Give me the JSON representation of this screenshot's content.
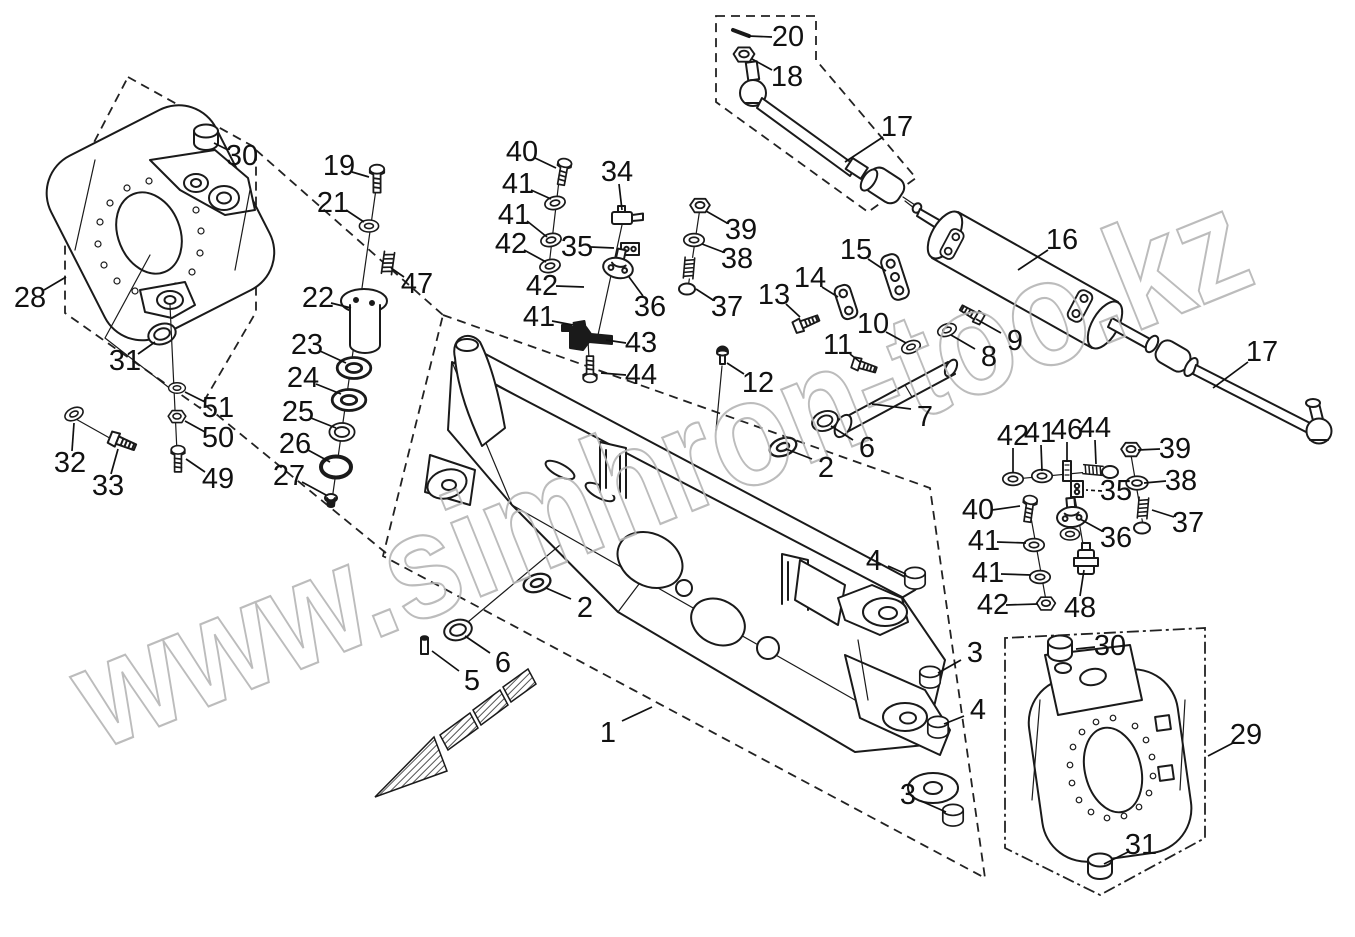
{
  "watermark": {
    "text": "www.simhron-too.kz",
    "color": "#b5b5b5"
  },
  "diagram": {
    "type": "exploded-parts-diagram",
    "subject": "front-axle-assembly",
    "line_color": "#1a1a1a",
    "background": "#ffffff",
    "callouts": [
      {
        "n": "1",
        "x": 608,
        "y": 733,
        "lead": [
          622,
          721,
          652,
          707
        ]
      },
      {
        "n": "2",
        "x": 585,
        "y": 608,
        "lead": [
          571,
          599,
          546,
          588
        ]
      },
      {
        "n": "2",
        "x": 826,
        "y": 468,
        "lead": [
          812,
          459,
          786,
          449
        ]
      },
      {
        "n": "3",
        "x": 975,
        "y": 653,
        "lead": [
          961,
          660,
          938,
          673
        ]
      },
      {
        "n": "3",
        "x": 908,
        "y": 795,
        "lead": [
          921,
          801,
          946,
          812
        ]
      },
      {
        "n": "4",
        "x": 874,
        "y": 561,
        "lead": [
          888,
          566,
          906,
          574
        ]
      },
      {
        "n": "4",
        "x": 978,
        "y": 710,
        "lead": [
          964,
          716,
          944,
          724
        ]
      },
      {
        "n": "5",
        "x": 472,
        "y": 681,
        "lead": [
          459,
          671,
          432,
          651
        ]
      },
      {
        "n": "6",
        "x": 503,
        "y": 663,
        "lead": [
          490,
          653,
          465,
          636
        ]
      },
      {
        "n": "6",
        "x": 867,
        "y": 448,
        "lead": [
          853,
          440,
          831,
          426
        ]
      },
      {
        "n": "7",
        "x": 925,
        "y": 417,
        "lead": [
          911,
          409,
          872,
          404
        ]
      },
      {
        "n": "8",
        "x": 989,
        "y": 357,
        "lead": [
          975,
          349,
          951,
          335
        ]
      },
      {
        "n": "9",
        "x": 1015,
        "y": 341,
        "lead": [
          1001,
          333,
          976,
          319
        ]
      },
      {
        "n": "10",
        "x": 873,
        "y": 324,
        "lead": [
          886,
          332,
          906,
          343
        ]
      },
      {
        "n": "11",
        "x": 838,
        "y": 345,
        "lead": [
          850,
          354,
          860,
          362
        ]
      },
      {
        "n": "12",
        "x": 758,
        "y": 383,
        "lead": [
          744,
          374,
          727,
          363
        ]
      },
      {
        "n": "13",
        "x": 774,
        "y": 295,
        "lead": [
          786,
          304,
          800,
          317
        ]
      },
      {
        "n": "14",
        "x": 810,
        "y": 278,
        "lead": [
          822,
          287,
          838,
          297
        ]
      },
      {
        "n": "15",
        "x": 856,
        "y": 250,
        "lead": [
          868,
          259,
          886,
          271
        ]
      },
      {
        "n": "16",
        "x": 1062,
        "y": 240,
        "lead": [
          1048,
          250,
          1018,
          270
        ]
      },
      {
        "n": "17",
        "x": 897,
        "y": 127,
        "lead": [
          883,
          137,
          845,
          162
        ]
      },
      {
        "n": "17",
        "x": 1262,
        "y": 352,
        "lead": [
          1248,
          362,
          1213,
          388
        ]
      },
      {
        "n": "18",
        "x": 787,
        "y": 77,
        "lead": [
          772,
          70,
          752,
          59
        ]
      },
      {
        "n": "19",
        "x": 339,
        "y": 166,
        "lead": [
          352,
          172,
          369,
          177
        ]
      },
      {
        "n": "20",
        "x": 788,
        "y": 37,
        "lead": [
          772,
          37,
          748,
          36
        ]
      },
      {
        "n": "21",
        "x": 333,
        "y": 203,
        "lead": [
          346,
          210,
          364,
          222
        ]
      },
      {
        "n": "22",
        "x": 318,
        "y": 298,
        "lead": [
          331,
          303,
          351,
          308
        ]
      },
      {
        "n": "23",
        "x": 307,
        "y": 345,
        "lead": [
          320,
          351,
          346,
          363
        ]
      },
      {
        "n": "24",
        "x": 303,
        "y": 378,
        "lead": [
          316,
          384,
          341,
          394
        ]
      },
      {
        "n": "25",
        "x": 298,
        "y": 412,
        "lead": [
          311,
          418,
          336,
          428
        ]
      },
      {
        "n": "26",
        "x": 295,
        "y": 444,
        "lead": [
          308,
          450,
          330,
          462
        ]
      },
      {
        "n": "27",
        "x": 289,
        "y": 476,
        "lead": [
          302,
          482,
          326,
          495
        ]
      },
      {
        "n": "28",
        "x": 30,
        "y": 298,
        "lead": [
          44,
          290,
          66,
          277
        ]
      },
      {
        "n": "29",
        "x": 1246,
        "y": 735,
        "lead": [
          1233,
          743,
          1208,
          756
        ]
      },
      {
        "n": "30",
        "x": 242,
        "y": 156,
        "lead": [
          228,
          150,
          214,
          143
        ]
      },
      {
        "n": "30",
        "x": 1110,
        "y": 646,
        "lead": [
          1095,
          647,
          1076,
          649
        ]
      },
      {
        "n": "31",
        "x": 125,
        "y": 361,
        "lead": [
          138,
          354,
          155,
          342
        ]
      },
      {
        "n": "31",
        "x": 1141,
        "y": 845,
        "lead": [
          1128,
          852,
          1104,
          864
        ]
      },
      {
        "n": "32",
        "x": 70,
        "y": 463,
        "lead": [
          72,
          451,
          74,
          423
        ]
      },
      {
        "n": "33",
        "x": 108,
        "y": 486,
        "lead": [
          111,
          474,
          118,
          449
        ]
      },
      {
        "n": "34",
        "x": 617,
        "y": 172,
        "lead": [
          619,
          184,
          622,
          210
        ]
      },
      {
        "n": "35",
        "x": 577,
        "y": 247,
        "lead": [
          591,
          247,
          614,
          248
        ]
      },
      {
        "n": "35",
        "x": 1116,
        "y": 491,
        "dashed": true,
        "lead": [
          1102,
          491,
          1086,
          490
        ]
      },
      {
        "n": "36",
        "x": 650,
        "y": 307,
        "lead": [
          643,
          296,
          629,
          277
        ]
      },
      {
        "n": "36",
        "x": 1116,
        "y": 538,
        "lead": [
          1102,
          531,
          1080,
          519
        ]
      },
      {
        "n": "37",
        "x": 727,
        "y": 307,
        "lead": [
          713,
          300,
          696,
          289
        ]
      },
      {
        "n": "37",
        "x": 1188,
        "y": 523,
        "lead": [
          1174,
          517,
          1152,
          510
        ]
      },
      {
        "n": "38",
        "x": 737,
        "y": 259,
        "lead": [
          723,
          252,
          702,
          244
        ]
      },
      {
        "n": "38",
        "x": 1181,
        "y": 481,
        "lead": [
          1166,
          481,
          1144,
          483
        ]
      },
      {
        "n": "39",
        "x": 741,
        "y": 230,
        "lead": [
          727,
          223,
          706,
          211
        ]
      },
      {
        "n": "39",
        "x": 1175,
        "y": 449,
        "lead": [
          1160,
          449,
          1138,
          450
        ]
      },
      {
        "n": "40",
        "x": 522,
        "y": 152,
        "lead": [
          535,
          158,
          556,
          168
        ]
      },
      {
        "n": "40",
        "x": 978,
        "y": 510,
        "lead": [
          992,
          510,
          1020,
          506
        ]
      },
      {
        "n": "41",
        "x": 518,
        "y": 184,
        "lead": [
          531,
          190,
          551,
          199
        ]
      },
      {
        "n": "41",
        "x": 514,
        "y": 215,
        "lead": [
          527,
          221,
          547,
          237
        ]
      },
      {
        "n": "41",
        "x": 539,
        "y": 317,
        "lead": [
          552,
          321,
          573,
          325
        ]
      },
      {
        "n": "41",
        "x": 1040,
        "y": 433,
        "lead": [
          1041,
          445,
          1042,
          471
        ]
      },
      {
        "n": "41",
        "x": 984,
        "y": 541,
        "lead": [
          997,
          542,
          1026,
          543
        ]
      },
      {
        "n": "41",
        "x": 988,
        "y": 573,
        "lead": [
          1001,
          574,
          1031,
          575
        ]
      },
      {
        "n": "42",
        "x": 511,
        "y": 244,
        "lead": [
          524,
          250,
          546,
          262
        ]
      },
      {
        "n": "42",
        "x": 542,
        "y": 286,
        "lead": [
          556,
          286,
          584,
          287
        ]
      },
      {
        "n": "42",
        "x": 1013,
        "y": 436,
        "lead": [
          1013,
          448,
          1013,
          473
        ]
      },
      {
        "n": "42",
        "x": 993,
        "y": 605,
        "lead": [
          1006,
          605,
          1038,
          604
        ]
      },
      {
        "n": "43",
        "x": 641,
        "y": 343,
        "lead": [
          626,
          343,
          606,
          340
        ]
      },
      {
        "n": "44",
        "x": 641,
        "y": 375,
        "lead": [
          626,
          375,
          601,
          373
        ]
      },
      {
        "n": "44",
        "x": 1095,
        "y": 428,
        "lead": [
          1095,
          440,
          1096,
          464
        ]
      },
      {
        "n": "46",
        "x": 1067,
        "y": 430,
        "lead": [
          1067,
          442,
          1067,
          462
        ]
      },
      {
        "n": "47",
        "x": 417,
        "y": 284,
        "lead": [
          404,
          277,
          391,
          268
        ]
      },
      {
        "n": "48",
        "x": 1080,
        "y": 608,
        "lead": [
          1080,
          596,
          1084,
          570
        ]
      },
      {
        "n": "49",
        "x": 218,
        "y": 479,
        "lead": [
          205,
          472,
          186,
          459
        ]
      },
      {
        "n": "50",
        "x": 218,
        "y": 438,
        "lead": [
          205,
          432,
          185,
          421
        ]
      },
      {
        "n": "51",
        "x": 218,
        "y": 408,
        "lead": [
          205,
          402,
          185,
          392
        ]
      }
    ]
  }
}
